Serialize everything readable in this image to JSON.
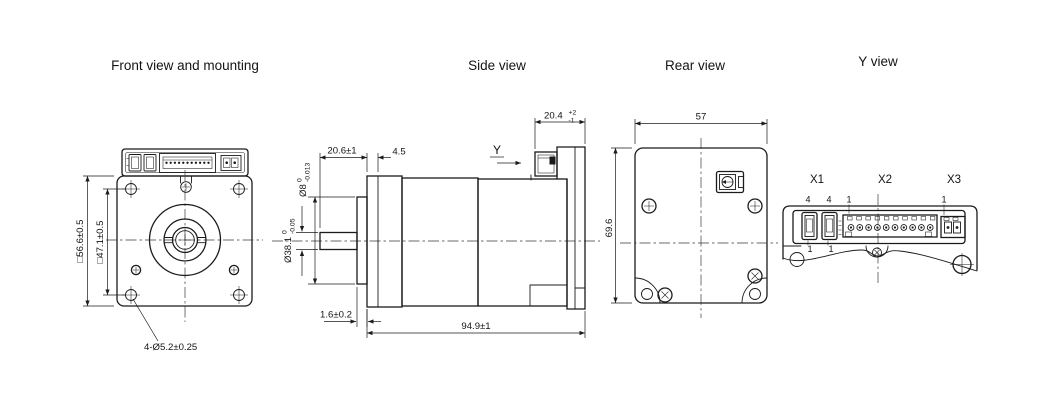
{
  "titles": {
    "front": "Front view and mounting",
    "side": "Side view",
    "rear": "Rear view",
    "y_view": "Y view"
  },
  "front": {
    "outer_square": "□56.6±0.5",
    "bolt_square": "□47.1±0.5",
    "mounting_holes": "4-Ø5.2±0.25"
  },
  "side": {
    "shaft_length": "20.6±1",
    "flange_thickness": "4.5",
    "direction_label": "Y",
    "connector_width": {
      "value": "20.4",
      "upper": "+2",
      "lower": "-1"
    },
    "shaft_diameter": {
      "value": "Ø8",
      "upper": "0",
      "lower": "-0.013"
    },
    "pilot_diameter": {
      "value": "Ø38.1",
      "upper": "0",
      "lower": "-0.05"
    },
    "pilot_height": "1.6±0.2",
    "total_length": "94.9±1"
  },
  "rear": {
    "width": "57",
    "height": "69.6"
  },
  "y_view": {
    "x1": {
      "label": "X1",
      "pin_top_a": "4",
      "pin_top_b": "4",
      "pin_bottom_a": "1",
      "pin_bottom_b": "1"
    },
    "x2": {
      "label": "X2",
      "pin_first": "1"
    },
    "x3": {
      "label": "X3",
      "pin_first": "1"
    }
  },
  "colors": {
    "line": "#1b1b1b",
    "background": "#ffffff"
  }
}
